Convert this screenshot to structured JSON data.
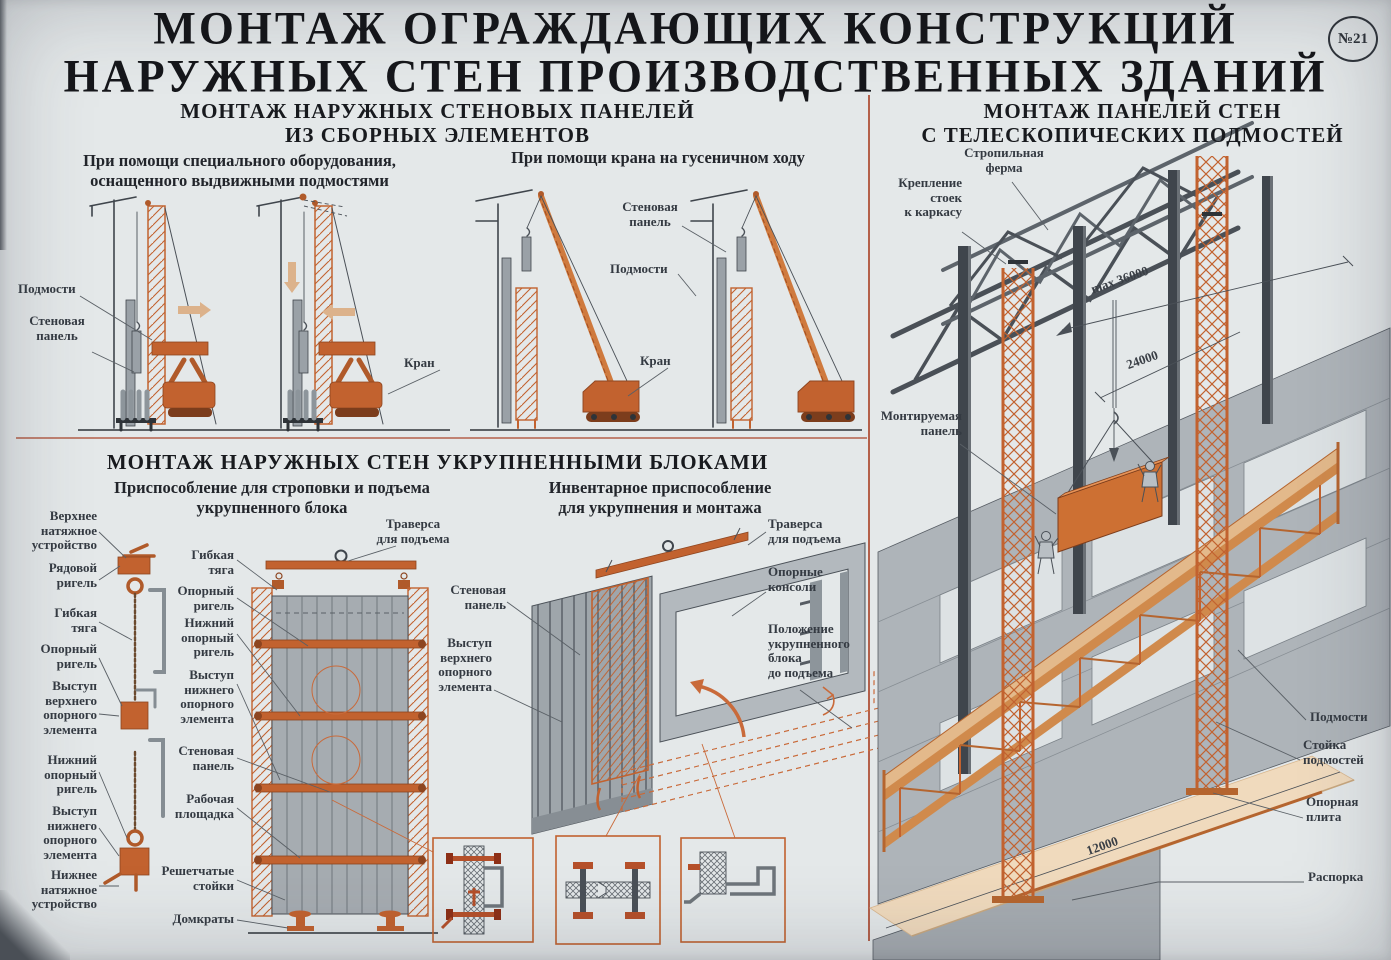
{
  "page": {
    "title_line1": "МОНТАЖ ОГРАЖДАЮЩИХ КОНСТРУКЦИЙ",
    "title_line2": "НАРУЖНЫХ СТЕН ПРОИЗВОДСТВЕННЫХ ЗДАНИЙ",
    "badge": "№21"
  },
  "colors": {
    "background": "#e4e8e9",
    "accent_orange": "#c2622f",
    "divider_red": "#b4604a",
    "steel_dark": "#4a5057",
    "panel_grey": "#a6acb1",
    "ground_tan": "#f0dabd",
    "arrow_beige": "#dcb28b"
  },
  "panels": {
    "title_line1": "МОНТАЖ НАРУЖНЫХ СТЕНОВЫХ ПАНЕЛЕЙ",
    "title_line2": "ИЗ СБОРНЫХ ЭЛЕМЕНТОВ",
    "caption_left_line1": "При помощи специального оборудования,",
    "caption_left_line2": "оснащенного выдвижными подмостями",
    "caption_right": "При помощи крана на гусеничном ходу",
    "labels": {
      "scaffold_left": "Подмости",
      "wall_panel_left": "Стеновая\nпанель",
      "crane_left": "Кран",
      "wall_panel_right": "Стеновая\nпанель",
      "scaffold_right": "Подмости",
      "crane_right": "Кран"
    }
  },
  "blocks": {
    "title": "МОНТАЖ НАРУЖНЫХ СТЕН УКРУПНЕННЫМИ БЛОКАМИ",
    "caption_left_line1": "Приспособление для строповки и подъема",
    "caption_left_line2": "укрупненного блока",
    "caption_right_line1": "Инвентарное приспособление",
    "caption_right_line2": "для укрупнения и монтажа",
    "labels": {
      "upper_tension": "Верхнее\nнатяжное\nустройство",
      "row_rigel": "Рядовой\nригель",
      "flexible_tie_1": "Гибкая\nтяга",
      "support_rigel_1": "Опорный\nригель",
      "upper_support_ledge_1": "Выступ\nверхнего\nопорного\nэлемента",
      "lower_support_rigel_1": "Нижний\nопорный\nригель",
      "lower_support_ledge_1": "Выступ\nнижнего\nопорного\nэлемента",
      "lower_tension": "Нижнее\nнатяжное\nустройство",
      "flexible_tie_2": "Гибкая\nтяга",
      "support_rigel_2": "Опорный\nригель",
      "lower_support_rigel_2": "Нижний\nопорный\nригель",
      "lower_support_ledge_2": "Выступ\nнижнего\nопорного\nэлемента",
      "wall_panel_2": "Стеновая\nпанель",
      "work_platform": "Рабочая\nплощадка",
      "lattice_stands": "Решетчатые\nстойки",
      "jacks": "Домкраты",
      "traverse_1": "Траверса\nдля подъема",
      "traverse_2": "Траверса\nдля подъема",
      "wall_panel_3": "Стеновая\nпанель",
      "upper_support_ledge_2": "Выступ\nверхнего\nопорного\nэлемента",
      "support_consoles": "Опорные\nконсоли",
      "block_position": "Положение\nукрупненного\nблока\nдо подъема"
    }
  },
  "telescopic": {
    "title_line1": "МОНТАЖ ПАНЕЛЕЙ СТЕН",
    "title_line2": "С ТЕЛЕСКОПИЧЕСКИХ ПОДМОСТЕЙ",
    "labels": {
      "truss": "Стропильная\nферма",
      "post_fastening": "Крепление\nстоек\nк каркасу",
      "mounted_panel": "Монтируемая\nпанель",
      "scaffold": "Подмости",
      "scaffold_post": "Стойка\nподмостей",
      "base_plate": "Опорная\nплита",
      "spacer": "Распорка"
    },
    "dimensions": {
      "max_height": "max 36000",
      "mid_height": "24000",
      "span": "12000"
    }
  }
}
